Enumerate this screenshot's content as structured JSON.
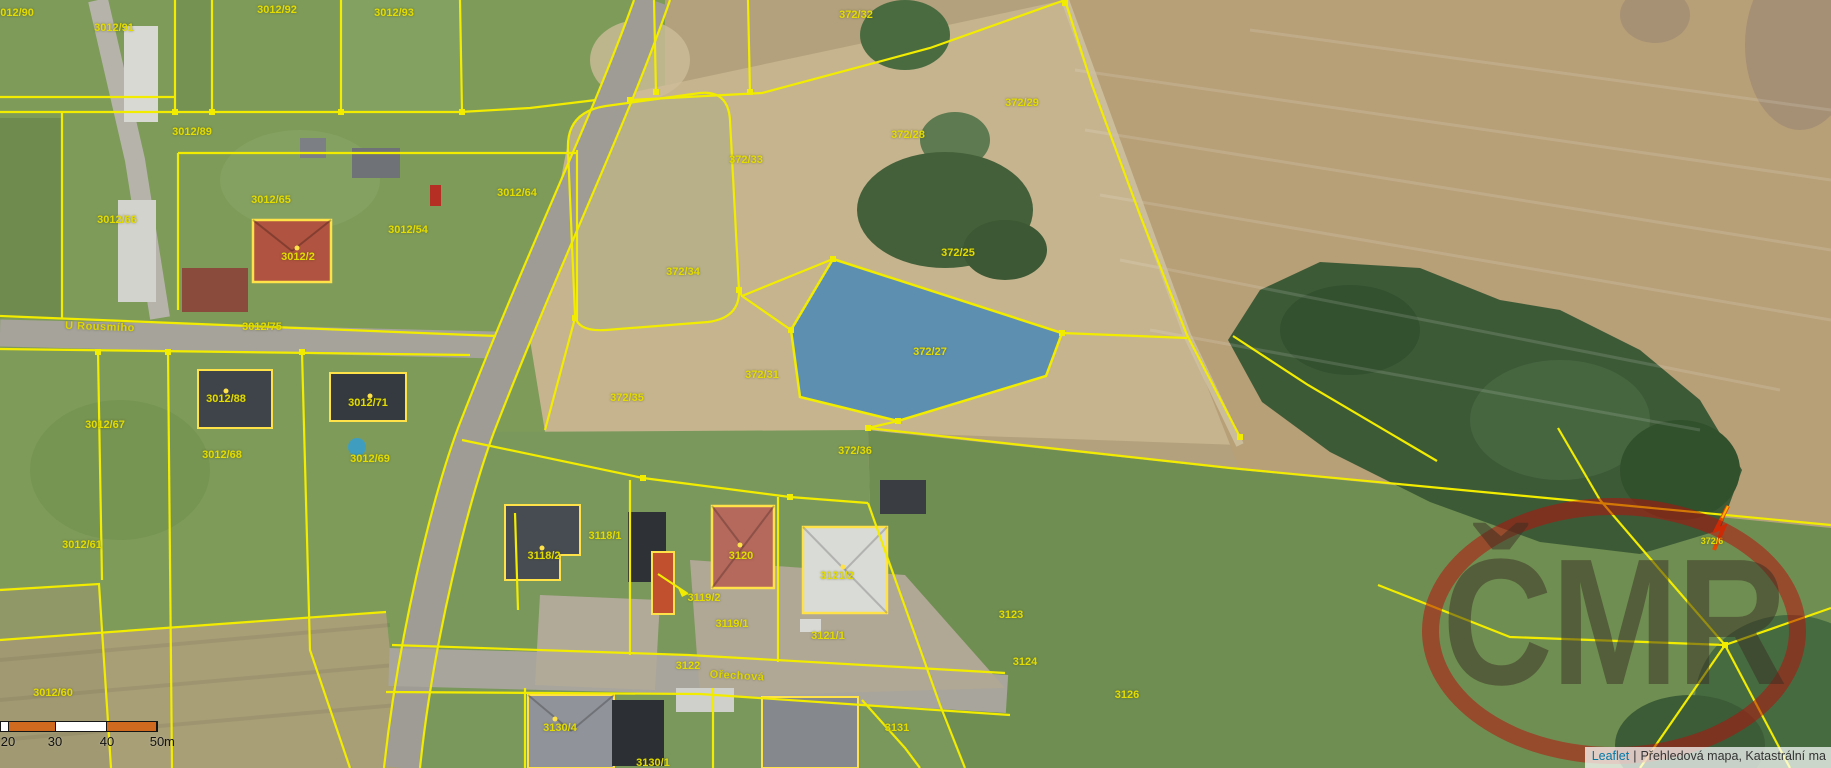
{
  "map": {
    "kind": "cadastral-aerial-map",
    "selected_parcel": "372/27",
    "boundary_color": "#f2ec00",
    "label_color": "#e3dc00",
    "highlight_fill": "#4586b8",
    "scale_bar": {
      "ticks": [
        "20",
        "30",
        "40",
        "50"
      ],
      "tick_x": [
        8,
        55,
        107,
        157
      ],
      "unit": "m",
      "segment_colors": [
        "#ffffff",
        "#cf6a1e",
        "#ffffff",
        "#cf6a1e"
      ],
      "segment_widths": [
        8,
        47,
        52,
        50
      ]
    },
    "attribution": {
      "leaflet_link": "Leaflet",
      "separator": "|",
      "layers_text": "Přehledová mapa, Katastrální ma"
    },
    "watermark": {
      "text": "ČMR",
      "ring_color": "#b90e0a"
    },
    "north_arrow": "orange-zigzag-arrow"
  },
  "parcel_labels": [
    {
      "t": "3012/90",
      "x": 14,
      "y": 13
    },
    {
      "t": "3012/91",
      "x": 114,
      "y": 28
    },
    {
      "t": "3012/92",
      "x": 277,
      "y": 10
    },
    {
      "t": "3012/93",
      "x": 394,
      "y": 13
    },
    {
      "t": "3012/89",
      "x": 192,
      "y": 132
    },
    {
      "t": "3012/65",
      "x": 271,
      "y": 200
    },
    {
      "t": "3012/54",
      "x": 408,
      "y": 230
    },
    {
      "t": "3012/64",
      "x": 517,
      "y": 193
    },
    {
      "t": "3012/2",
      "x": 298,
      "y": 257
    },
    {
      "t": "3012/66",
      "x": 117,
      "y": 220
    },
    {
      "t": "3012/75",
      "x": 262,
      "y": 327
    },
    {
      "t": "3012/67",
      "x": 105,
      "y": 425
    },
    {
      "t": "3012/88",
      "x": 226,
      "y": 399
    },
    {
      "t": "3012/71",
      "x": 368,
      "y": 403
    },
    {
      "t": "3012/68",
      "x": 222,
      "y": 455
    },
    {
      "t": "3012/69",
      "x": 370,
      "y": 459
    },
    {
      "t": "3012/61",
      "x": 82,
      "y": 545
    },
    {
      "t": "3012/60",
      "x": 53,
      "y": 693
    },
    {
      "t": "372/32",
      "x": 856,
      "y": 15
    },
    {
      "t": "372/29",
      "x": 1022,
      "y": 103
    },
    {
      "t": "372/28",
      "x": 908,
      "y": 135
    },
    {
      "t": "372/33",
      "x": 746,
      "y": 160
    },
    {
      "t": "372/34",
      "x": 683,
      "y": 272
    },
    {
      "t": "372/25",
      "x": 958,
      "y": 253
    },
    {
      "t": "372/31",
      "x": 762,
      "y": 375
    },
    {
      "t": "372/35",
      "x": 627,
      "y": 398
    },
    {
      "t": "372/27",
      "x": 930,
      "y": 352
    },
    {
      "t": "372/36",
      "x": 855,
      "y": 451
    },
    {
      "t": "3118/1",
      "x": 605,
      "y": 536
    },
    {
      "t": "3118/2",
      "x": 544,
      "y": 556
    },
    {
      "t": "3120",
      "x": 741,
      "y": 556
    },
    {
      "t": "3119/2",
      "x": 704,
      "y": 598
    },
    {
      "t": "3119/1",
      "x": 732,
      "y": 624
    },
    {
      "t": "3121/2",
      "x": 837,
      "y": 576
    },
    {
      "t": "3121/1",
      "x": 828,
      "y": 636
    },
    {
      "t": "3122",
      "x": 688,
      "y": 666
    },
    {
      "t": "3123",
      "x": 1011,
      "y": 615
    },
    {
      "t": "3124",
      "x": 1025,
      "y": 662
    },
    {
      "t": "3126",
      "x": 1127,
      "y": 695
    },
    {
      "t": "3130/4",
      "x": 560,
      "y": 728
    },
    {
      "t": "3130/1",
      "x": 653,
      "y": 763
    },
    {
      "t": "3131",
      "x": 897,
      "y": 728
    },
    {
      "t": "372/6",
      "x": 1712,
      "y": 541,
      "s": 9
    }
  ],
  "street_labels": [
    {
      "t": "U Rousmího",
      "x": 100,
      "y": 327,
      "r": 2
    },
    {
      "t": "Ořechová",
      "x": 737,
      "y": 676,
      "r": 3
    }
  ]
}
